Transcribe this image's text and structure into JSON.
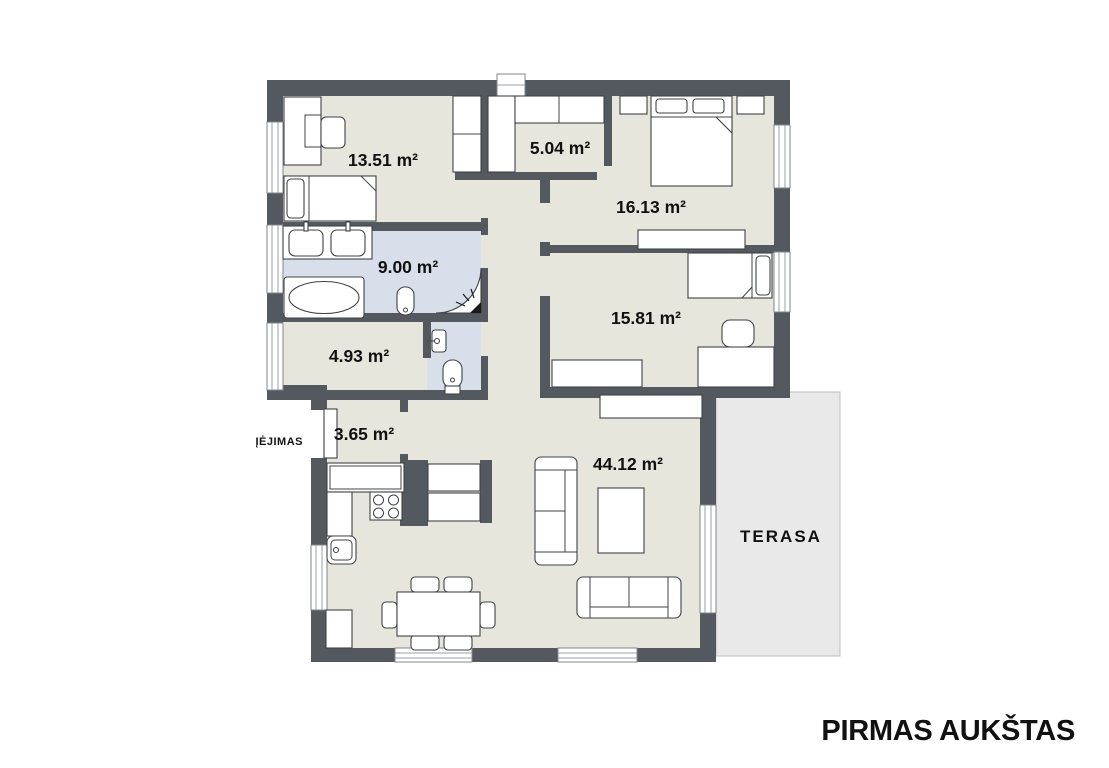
{
  "title": "PIRMAS AUKŠTAS",
  "labels": {
    "entrance": "ĮĖJIMAS",
    "terrace": "TERASA"
  },
  "rooms": [
    {
      "id": "bedroom-1",
      "area_label": "13.51 m²"
    },
    {
      "id": "closet",
      "area_label": "5.04 m²"
    },
    {
      "id": "bedroom-2",
      "area_label": "16.13 m²"
    },
    {
      "id": "bathroom",
      "area_label": "9.00 m²"
    },
    {
      "id": "bedroom-3",
      "area_label": "15.81 m²"
    },
    {
      "id": "utility-room",
      "area_label": "4.93 m²"
    },
    {
      "id": "entry-hall",
      "area_label": "3.65 m²"
    },
    {
      "id": "living-room",
      "area_label": "44.12 m²"
    }
  ],
  "icons": {
    "shower_head": "shower-spray-icon"
  },
  "colors": {
    "wall": "#54585F",
    "floor": "#E7E6DC",
    "bathroom_floor": "#D9DFEA",
    "terrace": "#E9E9E9",
    "background": "#FFFFFF",
    "text": "#111111"
  }
}
